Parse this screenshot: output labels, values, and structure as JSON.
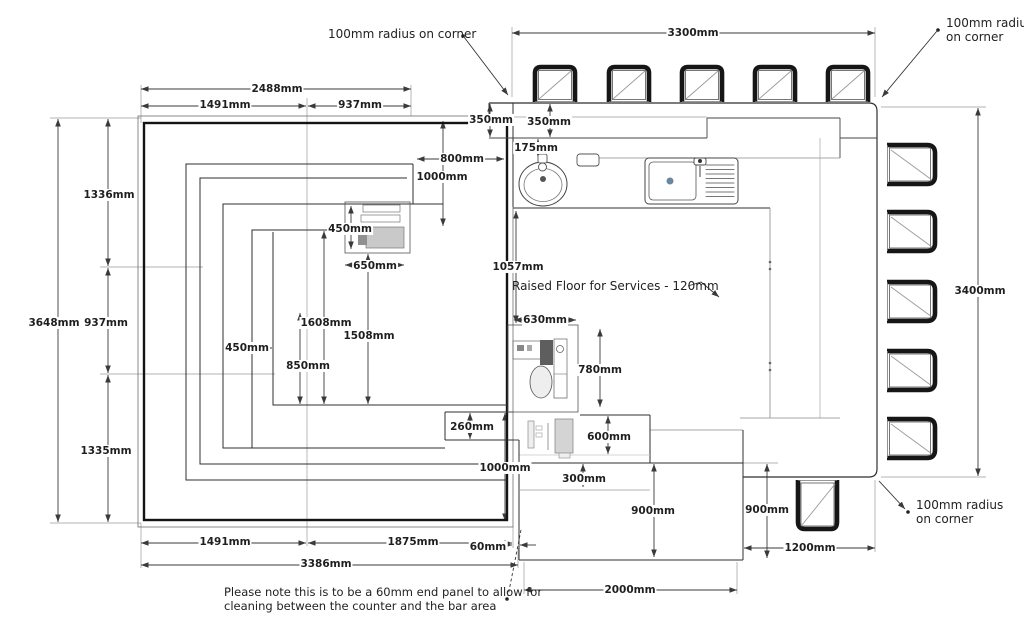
{
  "drawing": {
    "type": "floor-plan",
    "subject": "bar counter and raised floor layout plan",
    "units": "mm",
    "background_color": "#ffffff",
    "line_color": "#2f2f2f",
    "text_color": "#1f1f1f"
  },
  "annotations": {
    "radius_top_left": "100mm radius on corner",
    "radius_top_right_line1": "100mm radius",
    "radius_top_right_line2": "on corner",
    "radius_bottom_right_line1": "100mm radius",
    "radius_bottom_right_line2": "on corner",
    "raised_floor": "Raised Floor for Services - 120mm",
    "note_line1": "Please note this is to be a 60mm end panel to allow for",
    "note_line2": "cleaning between the counter and the bar area"
  },
  "fixtures": {
    "top_stool_count": 5,
    "right_stool_count": 5,
    "bottom_stool_count": 1,
    "items": [
      "bar stools",
      "round hand sink",
      "sink with drainer",
      "soap dish",
      "coffee machine",
      "glasswasher",
      "under-counter appliances",
      "60mm end panel"
    ]
  },
  "dimensions": [
    {
      "name": "2488mm-top",
      "text": "2488mm",
      "x": 277,
      "y": 89
    },
    {
      "name": "1491mm-top",
      "text": "1491mm",
      "x": 225,
      "y": 105
    },
    {
      "name": "937mm-top",
      "text": "937mm",
      "x": 360,
      "y": 105
    },
    {
      "name": "350mm-a",
      "text": "350mm",
      "x": 491,
      "y": 120
    },
    {
      "name": "350mm-b",
      "text": "350mm",
      "x": 549,
      "y": 122
    },
    {
      "name": "175mm",
      "text": "175mm",
      "x": 536,
      "y": 148
    },
    {
      "name": "800mm",
      "text": "800mm",
      "x": 462,
      "y": 159
    },
    {
      "name": "1000mm-a",
      "text": "1000mm",
      "x": 442,
      "y": 177
    },
    {
      "name": "450mm-top",
      "text": "450mm",
      "x": 350,
      "y": 229
    },
    {
      "name": "650mm",
      "text": "650mm",
      "x": 375,
      "y": 266
    },
    {
      "name": "1057mm",
      "text": "1057mm",
      "x": 518,
      "y": 267
    },
    {
      "name": "3300mm",
      "text": "3300mm",
      "x": 693,
      "y": 33
    },
    {
      "name": "3400mm",
      "text": "3400mm",
      "x": 980,
      "y": 291
    },
    {
      "name": "630mm",
      "text": "630mm",
      "x": 545,
      "y": 320
    },
    {
      "name": "780mm",
      "text": "780mm",
      "x": 600,
      "y": 370
    },
    {
      "name": "600mm",
      "text": "600mm",
      "x": 609,
      "y": 437
    },
    {
      "name": "300mm",
      "text": "300mm",
      "x": 584,
      "y": 479
    },
    {
      "name": "260mm",
      "text": "260mm",
      "x": 472,
      "y": 427
    },
    {
      "name": "1000mm-b",
      "text": "1000mm",
      "x": 505,
      "y": 468
    },
    {
      "name": "900mm-a",
      "text": "900mm",
      "x": 653,
      "y": 511
    },
    {
      "name": "900mm-b",
      "text": "900mm",
      "x": 767,
      "y": 510
    },
    {
      "name": "1200mm",
      "text": "1200mm",
      "x": 810,
      "y": 548
    },
    {
      "name": "2000mm",
      "text": "2000mm",
      "x": 630,
      "y": 590
    },
    {
      "name": "1491mm-bottom",
      "text": "1491mm",
      "x": 225,
      "y": 542
    },
    {
      "name": "1875mm",
      "text": "1875mm",
      "x": 413,
      "y": 542
    },
    {
      "name": "60mm",
      "text": "60mm",
      "x": 488,
      "y": 547
    },
    {
      "name": "3386mm",
      "text": "3386mm",
      "x": 326,
      "y": 564
    },
    {
      "name": "3648mm",
      "text": "3648mm",
      "x": 54,
      "y": 323
    },
    {
      "name": "937mm-left",
      "text": "937mm",
      "x": 106,
      "y": 323
    },
    {
      "name": "1336mm",
      "text": "1336mm",
      "x": 109,
      "y": 195
    },
    {
      "name": "1335mm",
      "text": "1335mm",
      "x": 106,
      "y": 451
    },
    {
      "name": "450mm-mid",
      "text": "450mm",
      "x": 247,
      "y": 348
    },
    {
      "name": "850mm",
      "text": "850mm",
      "x": 308,
      "y": 366
    },
    {
      "name": "1608mm",
      "text": "1608mm",
      "x": 326,
      "y": 323
    },
    {
      "name": "1508mm",
      "text": "1508mm",
      "x": 369,
      "y": 336
    }
  ]
}
